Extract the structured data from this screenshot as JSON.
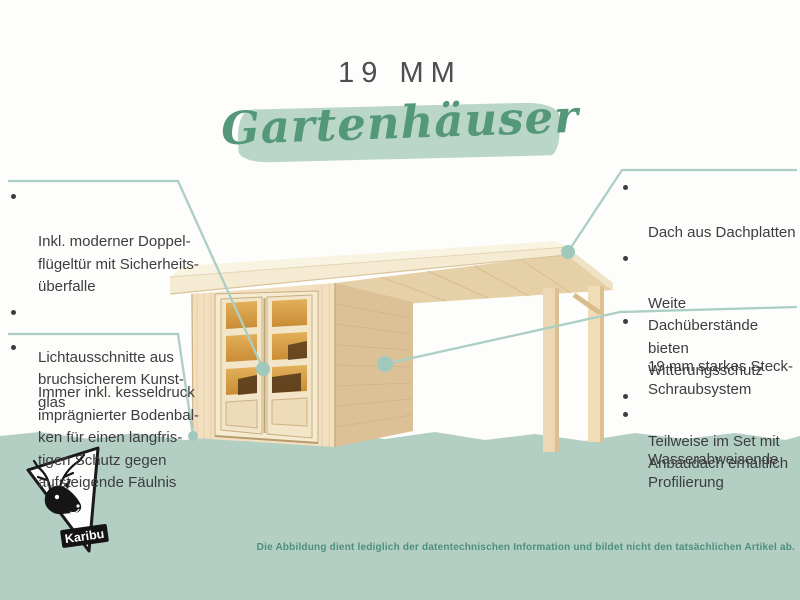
{
  "header": {
    "size_label": "19 MM",
    "title": "Gartenhäuser"
  },
  "callouts": {
    "left_top": [
      {
        "text": "Inkl. moderner Doppel-\nflügeltür mit Sicherheits-\nüberfalle"
      },
      {
        "text": "Lichtausschnitte aus\nbruchsicherem Kunst-\nglas"
      }
    ],
    "left_bottom": [
      {
        "text": "Immer inkl. kesseldruck\nimprägnierter Bodenbal-\nken für einen langfris-\ntigen Schutz gegen\naufsteigende Fäulnis"
      }
    ],
    "right_top": [
      {
        "text": "Dach aus Dachplatten"
      },
      {
        "text": "Weite Dachüberstände\nbieten Witterungsschutz"
      },
      {
        "text": "Teilweise im Set mit\nAnbaudach erhältlich"
      }
    ],
    "right_bottom": [
      {
        "text": "19 mm starkes Steck-\nSchraubsystem"
      },
      {
        "text": "Wasserabweisende\nProfilierung"
      }
    ]
  },
  "footer": {
    "disclaimer": "Die Abbildung dient lediglich der datentechnischen Information und bildet nicht den tatsächlichen Artikel ab."
  },
  "logo": {
    "brand": "Karibu",
    "icon": "deer-triangle-logo"
  },
  "colors": {
    "accent_green": "#549879",
    "brush_green": "#b9d6c9",
    "band_green": "#b3cfc3",
    "leader_line": "#abcfc3",
    "text_dark": "#3d3d3d",
    "disclaimer_green": "#4e8f7a",
    "wood_light": "#f1dfbf",
    "wood_side": "#dcc197",
    "glass_orange": "#d4973e"
  }
}
